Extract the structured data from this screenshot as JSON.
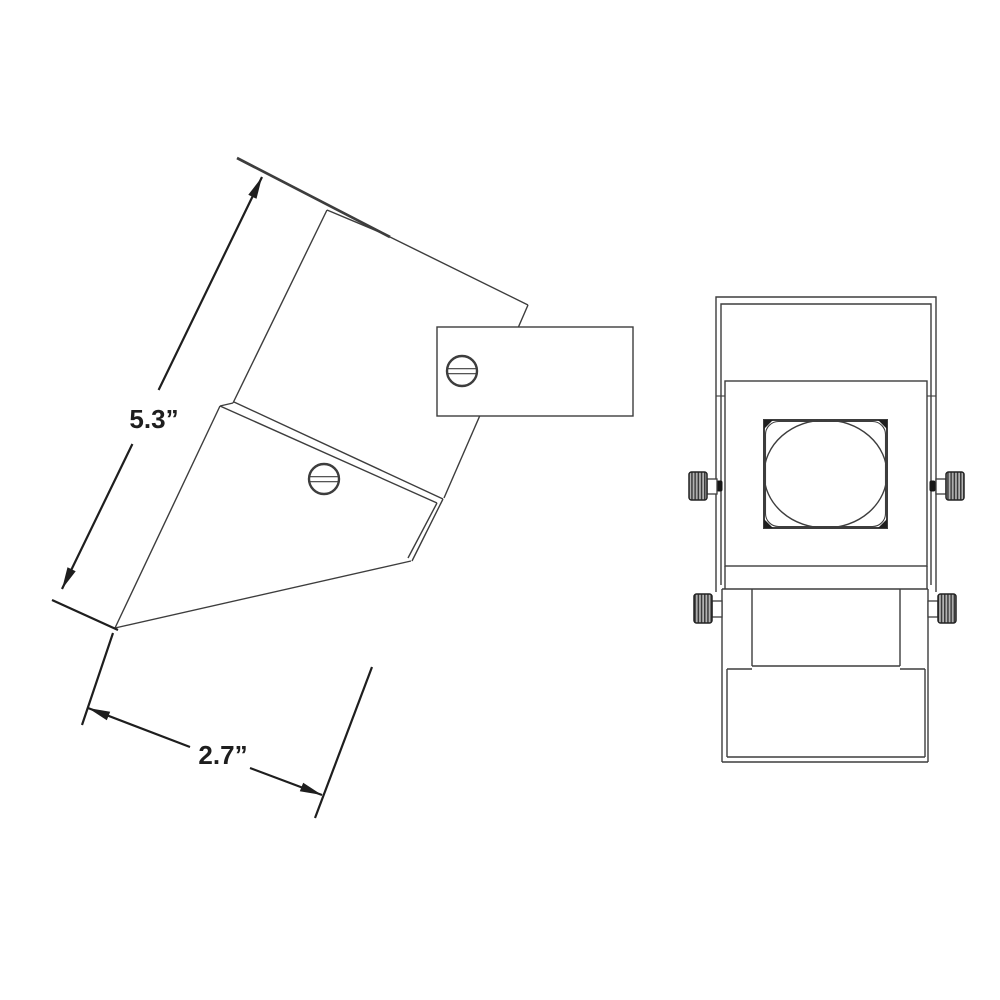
{
  "canvas": {
    "width": 1000,
    "height": 1000,
    "background": "#ffffff"
  },
  "drawing": {
    "kind": "dimensioned-technical-drawing",
    "views": {
      "side": {
        "name": "side-view",
        "dimensions": {
          "length_label": "5.3”",
          "width_label": "2.7”"
        }
      },
      "front": {
        "name": "front-view"
      }
    },
    "colors": {
      "outline": "#3d3d3d",
      "dimension": "#1e1e1e",
      "knob_base": "#b3b3b3",
      "knob_stripe": "#3a3a3a",
      "background": "#ffffff"
    }
  }
}
